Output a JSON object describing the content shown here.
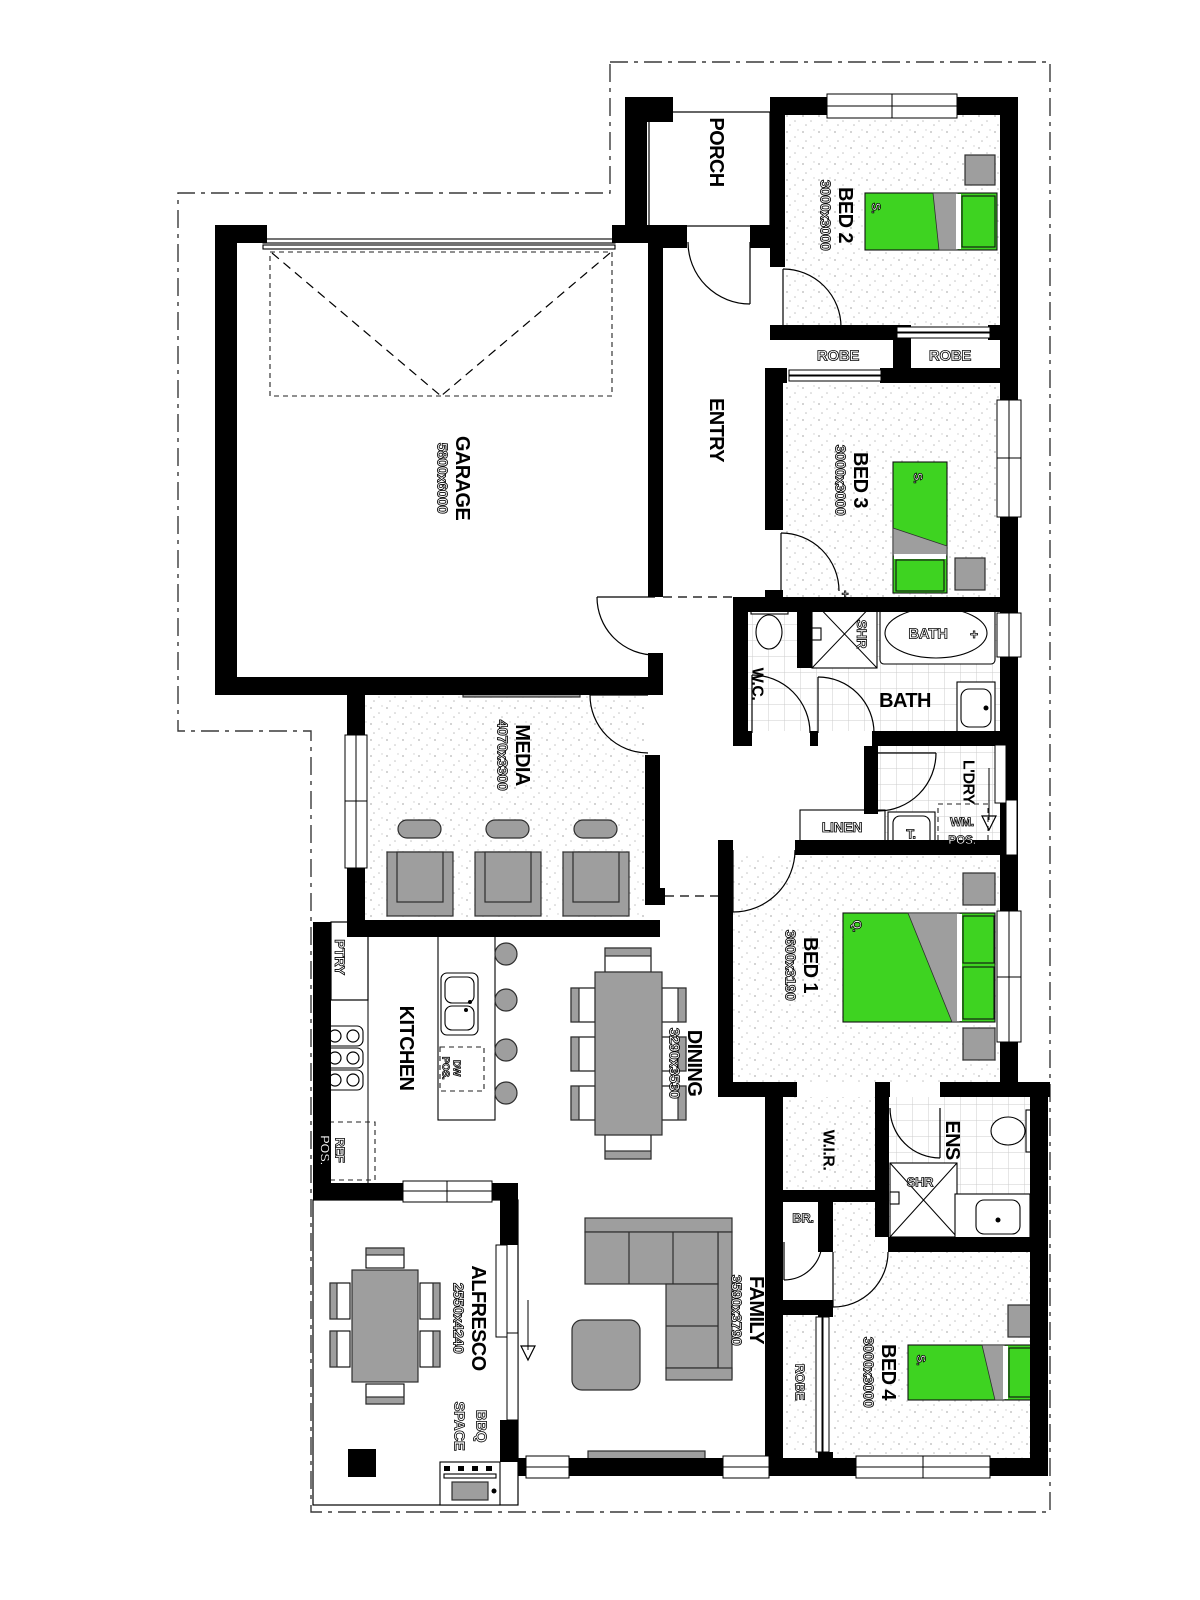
{
  "title": "Single storey house floor plan",
  "colors": {
    "wall_black": "#000000",
    "bed_green": "#3ed321",
    "furniture_gray": "#9e9e9e",
    "tile_line": "#cccccc",
    "stipple_dot": "#b5b5b5"
  },
  "rooms": {
    "porch": {
      "label": "PORCH"
    },
    "garage": {
      "label": "GARAGE",
      "dims": "5800x6000"
    },
    "entry": {
      "label": "ENTRY"
    },
    "bed2": {
      "label": "BED 2",
      "dims": "3000x3000",
      "bed": "S."
    },
    "robe_bed2": {
      "label": "ROBE"
    },
    "robe_bed3": {
      "label": "ROBE"
    },
    "bed3": {
      "label": "BED 3",
      "dims": "3000x3000",
      "bed": "S."
    },
    "wc": {
      "label": "W.C."
    },
    "bath": {
      "label": "BATH",
      "shower": "SHR",
      "tub": "BATH",
      "tub_tap": "+"
    },
    "laundry": {
      "label": "L'DRY",
      "wm": [
        "WM.",
        "POS."
      ],
      "trough": "T.",
      "linen": "LINEN"
    },
    "bed1": {
      "label": "BED 1",
      "dims": "3600x3190",
      "bed": "Q."
    },
    "media": {
      "label": "MEDIA",
      "dims": "4070x3300"
    },
    "kitchen": {
      "label": "KITCHEN",
      "pantry": "PTRY",
      "fridge": [
        "REF",
        "POS."
      ],
      "dishwasher": [
        "DW",
        "POS."
      ]
    },
    "dining": {
      "label": "DINING",
      "dims": "3290x3530"
    },
    "wir": {
      "label": "W.I.R."
    },
    "ens": {
      "label": "ENS",
      "shower": "SHR"
    },
    "broom": {
      "label": "BR."
    },
    "family": {
      "label": "FAMILY",
      "dims": "3590x3790"
    },
    "robe_bed4": {
      "label": "ROBE"
    },
    "bed4": {
      "label": "BED 4",
      "dims": "3000x3000",
      "bed": "S."
    },
    "alfresco": {
      "label": "ALFRESCO",
      "dims": "2550x4240",
      "bbq": [
        "BBQ",
        "SPACE"
      ]
    }
  }
}
